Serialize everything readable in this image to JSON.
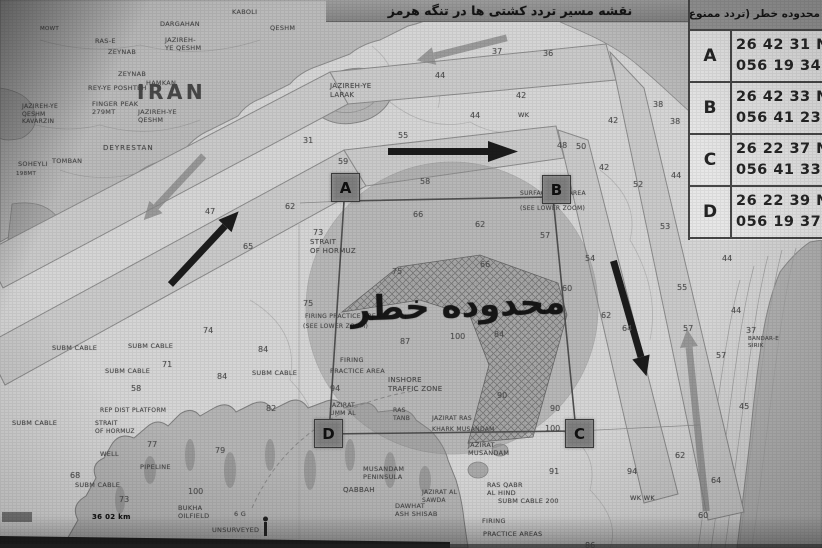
{
  "header": {
    "title": "نقشه مسیر تردد کشتی ها در تنگه هرمز"
  },
  "coords_table": {
    "header": "محدوده خطر (تردد ممنوع)",
    "rows": [
      {
        "point": "A",
        "lat": "26 42 31 N",
        "lon": "056 19 34 E"
      },
      {
        "point": "B",
        "lat": "26 42 33 N",
        "lon": "056 41 23 E"
      },
      {
        "point": "C",
        "lat": "26 22 37 N",
        "lon": "056 41 33 E"
      },
      {
        "point": "D",
        "lat": "26 22 39 N",
        "lon": "056 19 37 E"
      }
    ]
  },
  "map": {
    "danger_zone_label": "محدوده خطر",
    "corners": [
      {
        "letter": "A",
        "x": 331,
        "y": 173
      },
      {
        "letter": "B",
        "x": 542,
        "y": 175
      },
      {
        "letter": "C",
        "x": 565,
        "y": 419
      },
      {
        "letter": "D",
        "x": 314,
        "y": 419
      }
    ],
    "labels": [
      {
        "t": "IRAN",
        "x": 137,
        "y": 80,
        "s": 20,
        "b": true,
        "ls": 3.5
      },
      {
        "t": "DARGAHAN",
        "x": 160,
        "y": 20
      },
      {
        "t": "KABOLI",
        "x": 232,
        "y": 8
      },
      {
        "t": "QESHM",
        "x": 270,
        "y": 24
      },
      {
        "t": "MOWT",
        "x": 40,
        "y": 26,
        "s": 5.5
      },
      {
        "t": "RAS-E",
        "x": 95,
        "y": 37
      },
      {
        "t": "ZEYNAB",
        "x": 108,
        "y": 48
      },
      {
        "t": "JAZIREH-\nYE QESHM",
        "x": 165,
        "y": 36
      },
      {
        "t": "ZEYNAB",
        "x": 118,
        "y": 70
      },
      {
        "t": "REY-YE POSHTEH",
        "x": 88,
        "y": 84
      },
      {
        "t": "HAMKAN",
        "x": 146,
        "y": 79
      },
      {
        "t": "FINGER PEAK\n279MT",
        "x": 92,
        "y": 100
      },
      {
        "t": "JAZIREH-YE\nQESHM",
        "x": 138,
        "y": 108
      },
      {
        "t": "JAZIREH-YE\nQESHM\nKAVARZIN",
        "x": 22,
        "y": 103,
        "s": 6
      },
      {
        "t": "DEYRESTAN",
        "x": 103,
        "y": 144,
        "s": 7,
        "ls": 1
      },
      {
        "t": "SOHEYLI",
        "x": 18,
        "y": 160
      },
      {
        "t": "TOMBAN",
        "x": 52,
        "y": 157
      },
      {
        "t": "198MT",
        "x": 16,
        "y": 171,
        "s": 5.5
      },
      {
        "t": "JAZIREH-YE\nLARAK",
        "x": 330,
        "y": 82,
        "s": 7
      },
      {
        "t": "STRAIT\nOF HORMUZ",
        "x": 310,
        "y": 238,
        "s": 7
      },
      {
        "t": "SUBM CABLE",
        "x": 52,
        "y": 344
      },
      {
        "t": "SUBM CABLE",
        "x": 128,
        "y": 342
      },
      {
        "t": "SUBM CABLE",
        "x": 105,
        "y": 367
      },
      {
        "t": "SUBM CABLE",
        "x": 12,
        "y": 419
      },
      {
        "t": "SUBM CABLE",
        "x": 75,
        "y": 481
      },
      {
        "t": "SUBM CABLE",
        "x": 252,
        "y": 369
      },
      {
        "t": "SUBM CABLE 200",
        "x": 498,
        "y": 497
      },
      {
        "t": "REP DIST PLATFORM",
        "x": 100,
        "y": 407,
        "s": 6
      },
      {
        "t": "STRAIT\nOF HORMUZ",
        "x": 95,
        "y": 420,
        "s": 6
      },
      {
        "t": "WELL",
        "x": 100,
        "y": 450
      },
      {
        "t": "PIPELINE",
        "x": 140,
        "y": 463
      },
      {
        "t": "BUKHA\nOILFIELD",
        "x": 178,
        "y": 504
      },
      {
        "t": "6 G",
        "x": 234,
        "y": 510
      },
      {
        "t": "UNSURVEYED",
        "x": 212,
        "y": 526
      },
      {
        "t": "FIRING PRACTICE AREA",
        "x": 305,
        "y": 313,
        "s": 6
      },
      {
        "t": "(SEE LOWER ZOOM)",
        "x": 303,
        "y": 323,
        "s": 6
      },
      {
        "t": "FIRING",
        "x": 340,
        "y": 356
      },
      {
        "t": "PRACTICE AREA",
        "x": 330,
        "y": 367
      },
      {
        "t": "INSHORE\nTRAFFIC ZONE",
        "x": 388,
        "y": 376,
        "s": 7
      },
      {
        "t": "SURFACE EXE. AREA",
        "x": 520,
        "y": 190,
        "s": 6
      },
      {
        "t": "(SEE LOWER ZOOM)",
        "x": 520,
        "y": 205,
        "s": 6
      },
      {
        "t": "JAZIRAT\nUMM AL",
        "x": 330,
        "y": 402,
        "s": 6
      },
      {
        "t": "RAS\nTANB",
        "x": 393,
        "y": 407,
        "s": 6
      },
      {
        "t": "JAZIRAT RAS",
        "x": 432,
        "y": 415,
        "s": 6
      },
      {
        "t": "KHARK MUSANDAM",
        "x": 432,
        "y": 426,
        "s": 6
      },
      {
        "t": "JAZIRAT\nMUSANDAM",
        "x": 468,
        "y": 441
      },
      {
        "t": "MUSANDAM\nPENINSULA",
        "x": 363,
        "y": 465
      },
      {
        "t": "QABBAH",
        "x": 343,
        "y": 486,
        "s": 7
      },
      {
        "t": "DAWHAT\nASH SHISAB",
        "x": 395,
        "y": 502
      },
      {
        "t": "RAS QABR\nAL HIND",
        "x": 487,
        "y": 481
      },
      {
        "t": "JAZIRAT AL\nSAWDA",
        "x": 422,
        "y": 489,
        "s": 6
      },
      {
        "t": "FIRING",
        "x": 482,
        "y": 517
      },
      {
        "t": "PRACTICE AREAS",
        "x": 483,
        "y": 530
      },
      {
        "t": "BANDAR-E\nSIRIK",
        "x": 748,
        "y": 336,
        "s": 5.5
      },
      {
        "t": "WK",
        "x": 518,
        "y": 111
      },
      {
        "t": "WK  WK",
        "x": 630,
        "y": 494
      },
      {
        "t": "36 02 km",
        "x": 92,
        "y": 513,
        "s": 7,
        "k": "dark"
      }
    ],
    "depths": [
      {
        "v": "59",
        "x": 338,
        "y": 157
      },
      {
        "v": "58",
        "x": 420,
        "y": 177
      },
      {
        "v": "66",
        "x": 413,
        "y": 210
      },
      {
        "v": "62",
        "x": 475,
        "y": 220
      },
      {
        "v": "57",
        "x": 540,
        "y": 231
      },
      {
        "v": "73",
        "x": 313,
        "y": 228
      },
      {
        "v": "75",
        "x": 392,
        "y": 267
      },
      {
        "v": "66",
        "x": 480,
        "y": 260
      },
      {
        "v": "60",
        "x": 562,
        "y": 284
      },
      {
        "v": "47",
        "x": 205,
        "y": 207
      },
      {
        "v": "62",
        "x": 285,
        "y": 202
      },
      {
        "v": "65",
        "x": 243,
        "y": 242
      },
      {
        "v": "75",
        "x": 303,
        "y": 299
      },
      {
        "v": "74",
        "x": 203,
        "y": 326
      },
      {
        "v": "84",
        "x": 258,
        "y": 345
      },
      {
        "v": "84",
        "x": 217,
        "y": 372
      },
      {
        "v": "94",
        "x": 330,
        "y": 384
      },
      {
        "v": "44",
        "x": 435,
        "y": 71
      },
      {
        "v": "42",
        "x": 516,
        "y": 91
      },
      {
        "v": "44",
        "x": 470,
        "y": 111
      },
      {
        "v": "31",
        "x": 303,
        "y": 136
      },
      {
        "v": "55",
        "x": 398,
        "y": 131
      },
      {
        "v": "37",
        "x": 492,
        "y": 47
      },
      {
        "v": "36",
        "x": 543,
        "y": 49
      },
      {
        "v": "42",
        "x": 608,
        "y": 116
      },
      {
        "v": "87",
        "x": 400,
        "y": 337
      },
      {
        "v": "100",
        "x": 450,
        "y": 332
      },
      {
        "v": "84",
        "x": 494,
        "y": 330
      },
      {
        "v": "90",
        "x": 497,
        "y": 391
      },
      {
        "v": "90",
        "x": 550,
        "y": 404
      },
      {
        "v": "100",
        "x": 545,
        "y": 424
      },
      {
        "v": "71",
        "x": 162,
        "y": 360
      },
      {
        "v": "58",
        "x": 131,
        "y": 384
      },
      {
        "v": "82",
        "x": 266,
        "y": 404
      },
      {
        "v": "79",
        "x": 215,
        "y": 446
      },
      {
        "v": "77",
        "x": 147,
        "y": 440
      },
      {
        "v": "68",
        "x": 70,
        "y": 471
      },
      {
        "v": "73",
        "x": 119,
        "y": 495
      },
      {
        "v": "100",
        "x": 188,
        "y": 487
      },
      {
        "v": "54",
        "x": 585,
        "y": 254
      },
      {
        "v": "62",
        "x": 601,
        "y": 311
      },
      {
        "v": "64",
        "x": 622,
        "y": 324
      },
      {
        "v": "53",
        "x": 660,
        "y": 222
      },
      {
        "v": "55",
        "x": 677,
        "y": 283
      },
      {
        "v": "57",
        "x": 683,
        "y": 324
      },
      {
        "v": "57",
        "x": 716,
        "y": 351
      },
      {
        "v": "44",
        "x": 722,
        "y": 254
      },
      {
        "v": "44",
        "x": 731,
        "y": 306
      },
      {
        "v": "37",
        "x": 746,
        "y": 326
      },
      {
        "v": "45",
        "x": 739,
        "y": 402
      },
      {
        "v": "64",
        "x": 711,
        "y": 476
      },
      {
        "v": "60",
        "x": 698,
        "y": 511
      },
      {
        "v": "91",
        "x": 549,
        "y": 467
      },
      {
        "v": "94",
        "x": 627,
        "y": 467
      },
      {
        "v": "62",
        "x": 675,
        "y": 451
      },
      {
        "v": "86",
        "x": 585,
        "y": 541
      },
      {
        "v": "38",
        "x": 653,
        "y": 100
      },
      {
        "v": "38",
        "x": 670,
        "y": 117
      },
      {
        "v": "48",
        "x": 557,
        "y": 141
      },
      {
        "v": "50",
        "x": 576,
        "y": 142
      },
      {
        "v": "42",
        "x": 599,
        "y": 163
      },
      {
        "v": "52",
        "x": 633,
        "y": 180
      },
      {
        "v": "44",
        "x": 671,
        "y": 171
      }
    ]
  }
}
